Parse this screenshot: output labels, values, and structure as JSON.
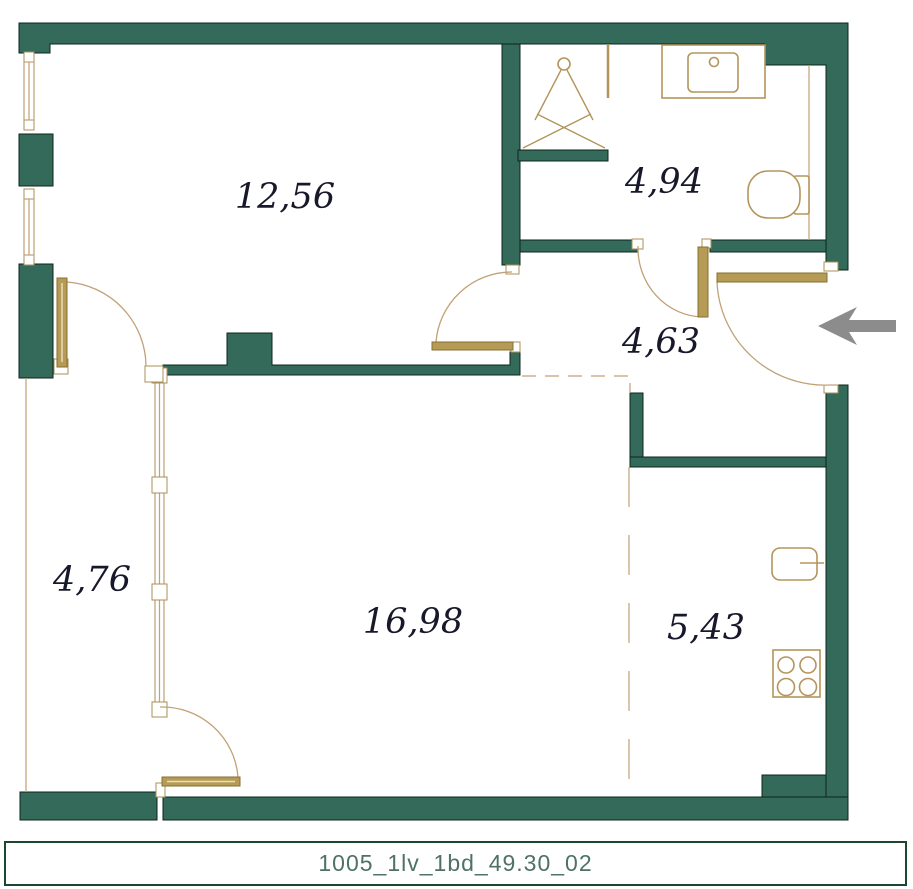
{
  "plan": {
    "title": "1005_1lv_1bd_49.30_02",
    "rooms": [
      {
        "id": "bedroom",
        "area": "12,56"
      },
      {
        "id": "bathroom",
        "area": "4,94"
      },
      {
        "id": "hallway",
        "area": "4,63"
      },
      {
        "id": "balcony",
        "area": "4,76"
      },
      {
        "id": "living-room",
        "area": "16,98"
      },
      {
        "id": "kitchen",
        "area": "5,43"
      }
    ],
    "fixtures": [
      "shower",
      "sink",
      "toilet",
      "fridge",
      "stove"
    ],
    "entrance": {
      "symbol": "arrow-left"
    },
    "colors": {
      "wall": "#346A59",
      "wall_outline": "#0E241D",
      "door_gold": "#B59B55",
      "thin_line": "#C2A176",
      "entry_arrow": "#8C8C8C",
      "label_text": "#18182B",
      "title_text": "#4E7363",
      "title_border": "#1B472F"
    }
  }
}
